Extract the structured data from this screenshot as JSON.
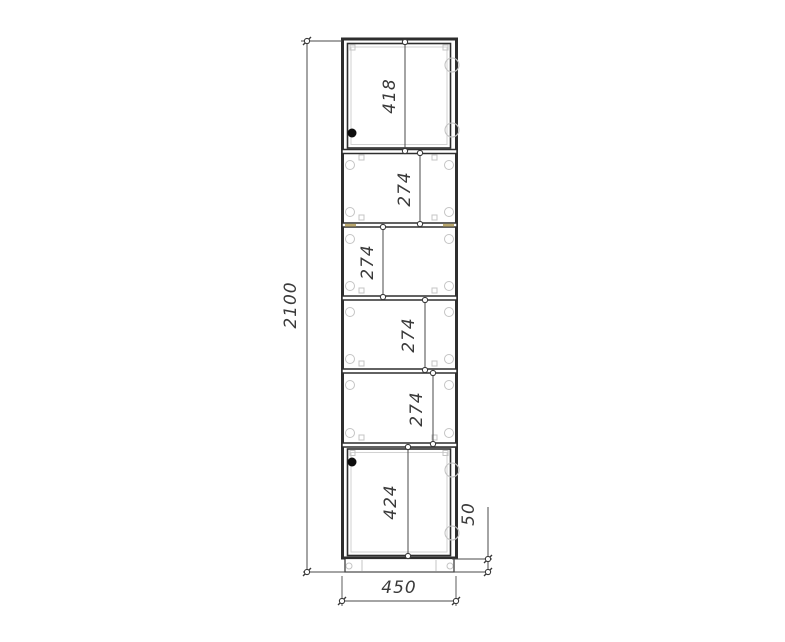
{
  "palette": {
    "body_line": "#2e2e2e",
    "dimension_line": "#4a4a4a",
    "detail_line": "#c4c4c4",
    "wood_mark": "#b9a76e",
    "handle": "#0d0d0d",
    "background": "#ffffff"
  },
  "dimensions": {
    "overall_height": "2100",
    "overall_width": "450",
    "plinth_height": "50",
    "sections_top_to_bottom": [
      "418",
      "274",
      "274",
      "274",
      "274",
      "424"
    ]
  }
}
